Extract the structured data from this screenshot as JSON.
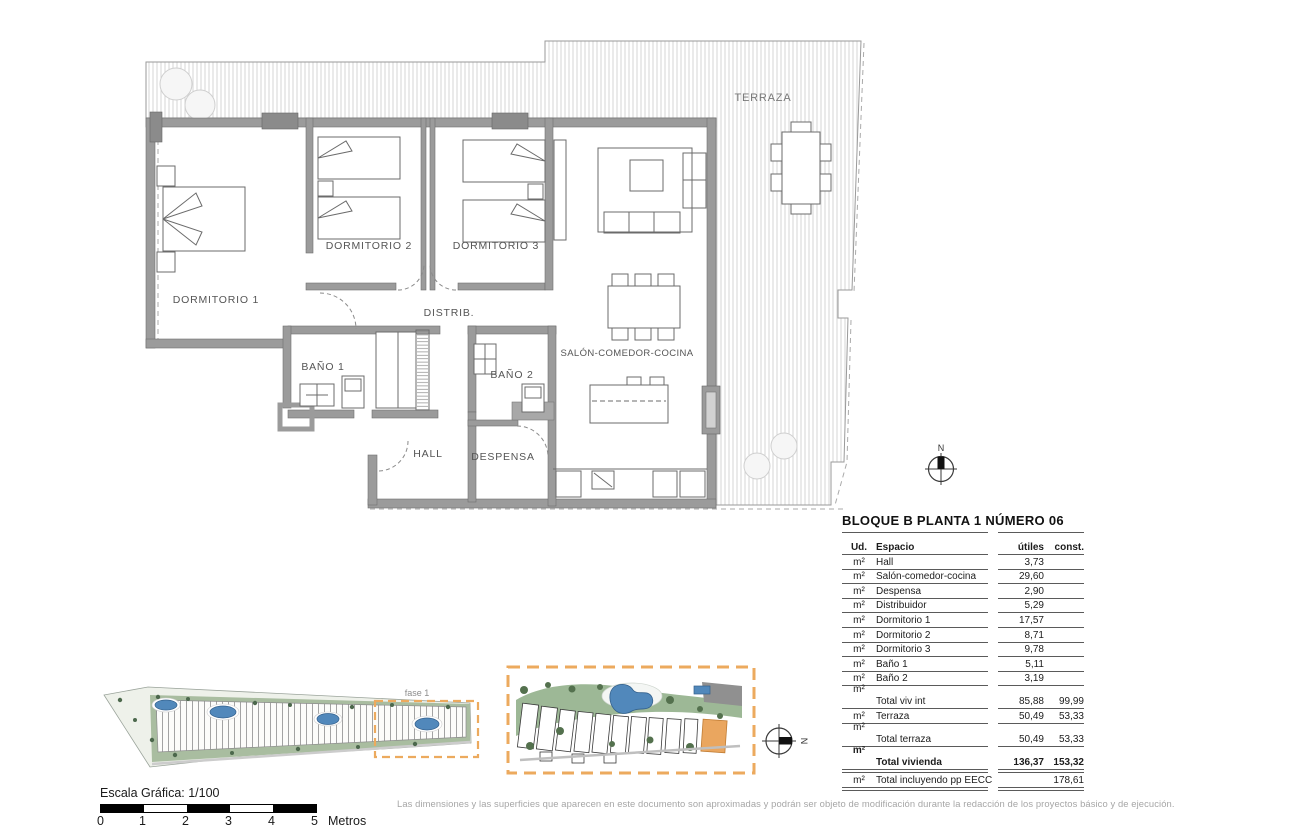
{
  "floor_plan": {
    "labels": {
      "terraza": "TERRAZA",
      "dormitorio1": "DORMITORIO 1",
      "dormitorio2": "DORMITORIO 2",
      "dormitorio3": "DORMITORIO 3",
      "distribuidor": "DISTRIB.",
      "bano1": "BAÑO 1",
      "bano2": "BAÑO 2",
      "hall": "HALL",
      "despensa": "DESPENSA",
      "salon": "SALÓN-COMEDOR-COCINA"
    },
    "north": "N"
  },
  "site_plans": {
    "fase_label": "fase 1",
    "north": "N"
  },
  "area_table": {
    "title": "BLOQUE B  PLANTA 1  NÚMERO 06",
    "columns": {
      "ud": "Ud.",
      "espacio": "Espacio",
      "utiles": "útiles",
      "const": "const."
    },
    "rows": [
      {
        "ud": "m²",
        "espacio": "Hall",
        "utiles": "3,73",
        "const": ""
      },
      {
        "ud": "m²",
        "espacio": "Salón-comedor-cocina",
        "utiles": "29,60",
        "const": ""
      },
      {
        "ud": "m²",
        "espacio": "Despensa",
        "utiles": "2,90",
        "const": ""
      },
      {
        "ud": "m²",
        "espacio": "Distribuidor",
        "utiles": "5,29",
        "const": ""
      },
      {
        "ud": "m²",
        "espacio": "Dormitorio 1",
        "utiles": "17,57",
        "const": ""
      },
      {
        "ud": "m²",
        "espacio": "Dormitorio 2",
        "utiles": "8,71",
        "const": ""
      },
      {
        "ud": "m²",
        "espacio": "Dormitorio 3",
        "utiles": "9,78",
        "const": ""
      },
      {
        "ud": "m²",
        "espacio": "Baño 1",
        "utiles": "5,11",
        "const": ""
      },
      {
        "ud": "m²",
        "espacio": "Baño 2",
        "utiles": "3,19",
        "const": ""
      },
      {
        "ud": "m²",
        "espacio": "Total viv int",
        "utiles": "85,88",
        "const": "99,99"
      },
      {
        "ud": "m²",
        "espacio": "Terraza",
        "utiles": "50,49",
        "const": "53,33"
      },
      {
        "ud": "m²",
        "espacio": "Total terraza",
        "utiles": "50,49",
        "const": "53,33"
      },
      {
        "ud": "m²",
        "espacio": "Total vivienda",
        "utiles": "136,37",
        "const": "153,32"
      },
      {
        "ud": "m²",
        "espacio": "Total incluyendo pp EECC",
        "utiles": "",
        "const": "178,61"
      }
    ]
  },
  "scale_bar": {
    "label": "Escala Gráfica:  1/100",
    "ticks": [
      "0",
      "1",
      "2",
      "3",
      "4",
      "5"
    ],
    "unit": "Metros"
  },
  "disclaimer": "Las dimensiones y las superficies que aparecen en este documento son aproximadas y podrán ser objeto de modificación durante la redacción de los proyectos básico y de ejecución.",
  "colors": {
    "wall": "#9b9b9b",
    "hatch": "#d6d6d6",
    "accent_orange": "#ecaa5e",
    "pool_blue": "#5188bb",
    "green": "#8aa682"
  }
}
